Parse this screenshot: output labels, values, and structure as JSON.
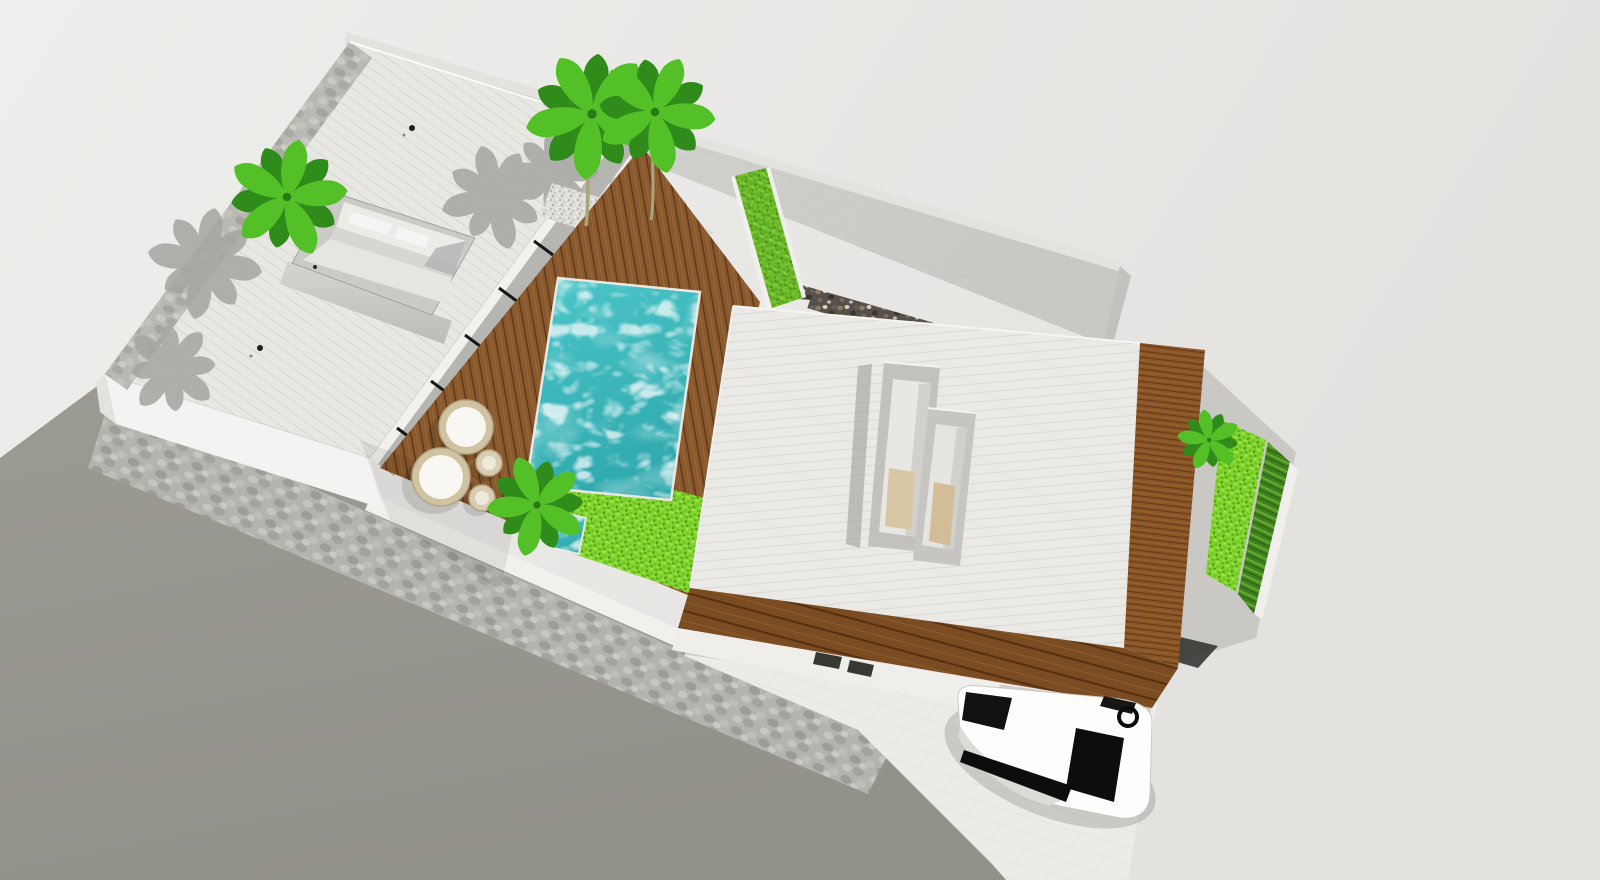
{
  "meta": {
    "scene_type": "3d-architectural-aerial-render",
    "style": "sketchup-like axonometric model view of a walled villa lot"
  },
  "palette": {
    "bg_left": "#efeeec",
    "bg_right": "#e2e1de",
    "street": "#9c9b92",
    "street_dark": "#93928a",
    "stone_base": "#b4b3ae",
    "wall_top_white": "#f1f0ed",
    "boundary_wall": "#d8d7d3",
    "boundary_wall_dark": "#c9c8c4",
    "pebble_dark": "#55504a",
    "pavilion_roof": "#e8e7e4",
    "pavilion_roof_line": "#d7d6d2",
    "main_roof": "#eae9e6",
    "main_roof_line": "#d9d8d4",
    "wood_deck": "#8a5a2e",
    "wood_deck_gap": "#60391b",
    "wood_eave": "#7b4c21",
    "wood_side": "#8a5527",
    "water": "#4cc6c9",
    "water_deep": "#2fa9ae",
    "grass": "#82d42c",
    "grass_dark": "#4a9f19",
    "hedge": "#4c8f24",
    "hedge_dark": "#2f6b15",
    "palm_light": "#54c028",
    "palm_dark": "#2f8c1a",
    "palm_shadow": "#a8a7a3",
    "gravel": "#dedcd6",
    "glass_band": "#b5b5b1",
    "mullion_black": "#161616",
    "fascia_white": "#f2f1ee",
    "skylight_frame": "#c2c1be",
    "skylight_inner": "#e9e7e3",
    "skylight_floor": "#d9c6a4",
    "driveway": "#ecebe7",
    "white_wall": "#f4f3f1",
    "car_body": "#fdfdfb",
    "car_glass": "#0d0d0c",
    "trunk": "#a9a67f",
    "wicker": "#cfc3a2",
    "cushion_white": "#f8f7f4"
  },
  "scene": {
    "objects": [
      {
        "id": "street-ground",
        "label": "street / ground plane outside the lot"
      },
      {
        "id": "perimeter-stone-wall",
        "label": "perimeter wall with stone cladding and white cap"
      },
      {
        "id": "rear-boundary-wall",
        "label": "tall gray boundary wall along the upper edge"
      },
      {
        "id": "pebble-feature-wall",
        "label": "dark pebble feature wall behind the main house"
      },
      {
        "id": "guest-pavilion",
        "label": "white flat-roof pavilion with roof void and glazed facade"
      },
      {
        "id": "roof-void",
        "label": "recessed roof opening showing interior walls"
      },
      {
        "id": "main-house",
        "label": "main house, white ribbed roof with timber fascia"
      },
      {
        "id": "skylight",
        "label": "double rectangular skylight on main roof"
      },
      {
        "id": "pool",
        "label": "rectangular turquoise swimming pool"
      },
      {
        "id": "plunge-pool",
        "label": "small plunge pool next to lawn"
      },
      {
        "id": "pool-deck",
        "label": "timber pool deck"
      },
      {
        "id": "lawn",
        "label": "bright lawn patch beside the deck"
      },
      {
        "id": "green-wall",
        "label": "vertical hedge planter strip"
      },
      {
        "id": "side-garden",
        "label": "east side garden with lawn strip and hedge row"
      },
      {
        "id": "gravel-bed",
        "label": "gravel planting bed with twin palms"
      },
      {
        "id": "daybeds",
        "label": "two round wicker daybeds with white cushions"
      },
      {
        "id": "side-tables",
        "label": "two rattan side tables"
      },
      {
        "id": "palms",
        "label": "green palm trees"
      },
      {
        "id": "palm-shadows",
        "label": "gray palm shadows cast on roof and wall"
      },
      {
        "id": "driveway",
        "label": "carport driveway"
      },
      {
        "id": "car",
        "label": "white sedan with black glazing parked under the carport"
      }
    ]
  },
  "counts": {
    "green_palms": 5,
    "shadow_palms": 5,
    "round_daybeds": 2,
    "rattan_side_tables": 2,
    "skylight_boxes": 2,
    "roof_drain_dots": 2
  }
}
